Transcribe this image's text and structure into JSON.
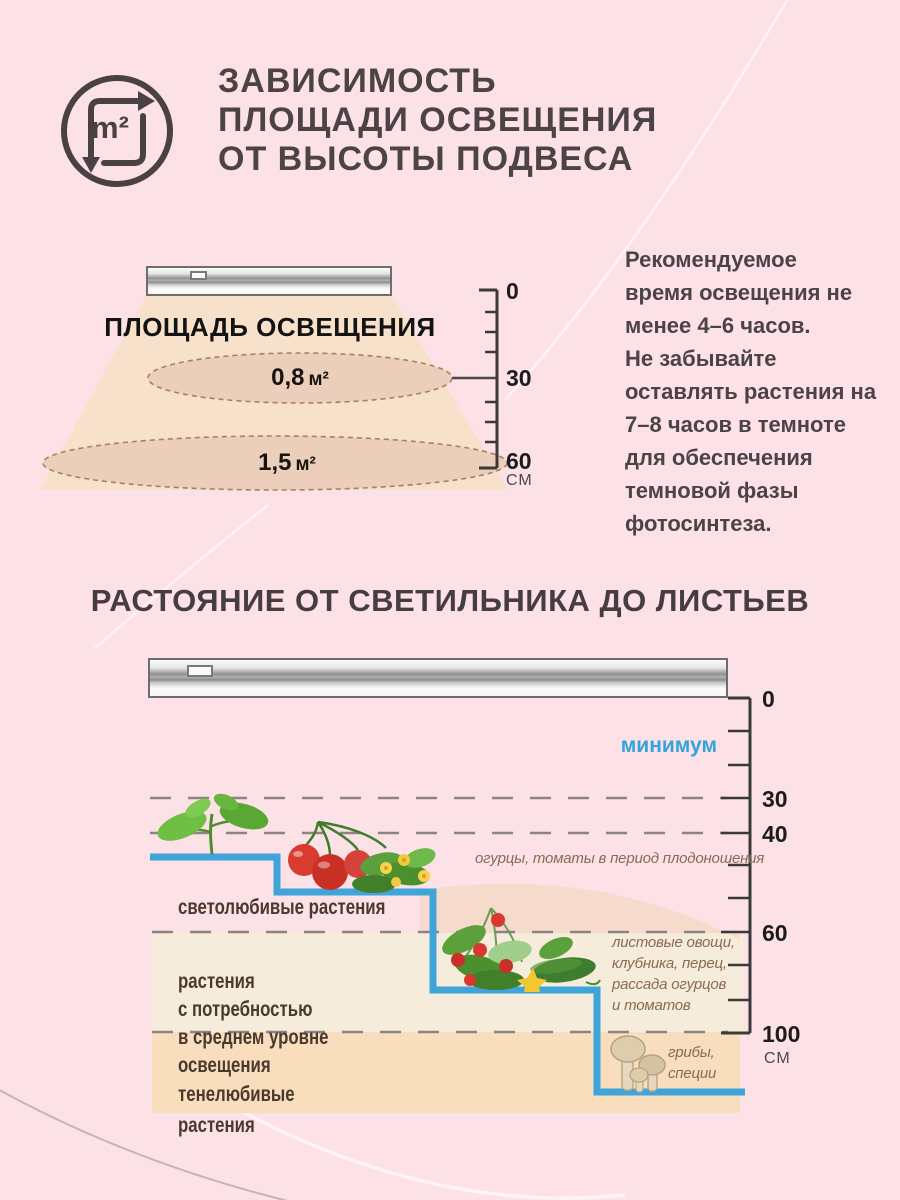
{
  "colors": {
    "background_pink": "#fce1e7",
    "accent_blue": "#3ea4da",
    "cone_peach": "#f8e1cb",
    "ellipse_fill": "#ebcfba",
    "band_cream": "#f5ecdc",
    "band_peach": "#f8debc",
    "annotation_brown": "#8a6a52",
    "dark_text": "#4c4347"
  },
  "section1": {
    "icon_label": "m²",
    "title": "ЗАВИСИМОСТЬ\nПЛОЩАДИ ОСВЕЩЕНИЯ\nОТ ВЫСОТЫ ПОДВЕСА",
    "cone_label": "ПЛОЩАДЬ ОСВЕЩЕНИЯ",
    "areas": [
      {
        "value": "0,8",
        "unit": "м²"
      },
      {
        "value": "1,5",
        "unit": "м²"
      }
    ],
    "ruler": {
      "tick_labels": [
        "0",
        "30",
        "60"
      ],
      "unit": "СМ"
    },
    "note": "Рекомендуемое\nвремя освещения не\nменее 4–6 часов.\nНе забывайте\nоставлять растения на\n7–8 часов в темноте\nдля обеспечения\nтемновой фазы\nфотосинтеза."
  },
  "section2": {
    "title": "РАСТОЯНИЕ ОТ СВЕТИЛЬНИКА ДО ЛИСТЬЕВ",
    "minimum_label": "минимум",
    "ruler": {
      "tick_labels": [
        "0",
        "30",
        "40",
        "60",
        "100"
      ],
      "unit": "СМ"
    },
    "groups": [
      {
        "label": "светолюбивые растения",
        "plants": "огурцы, томаты в период плодоношения"
      },
      {
        "label": "растения\nс потребностью\nв среднем уровне\nосвещения",
        "plants": "листовые овощи,\nклубника, перец,\nрассада огурцов\nи томатов"
      },
      {
        "label": "тенелюбивые\nрастения",
        "plants": "грибы,\nспеции"
      }
    ]
  }
}
